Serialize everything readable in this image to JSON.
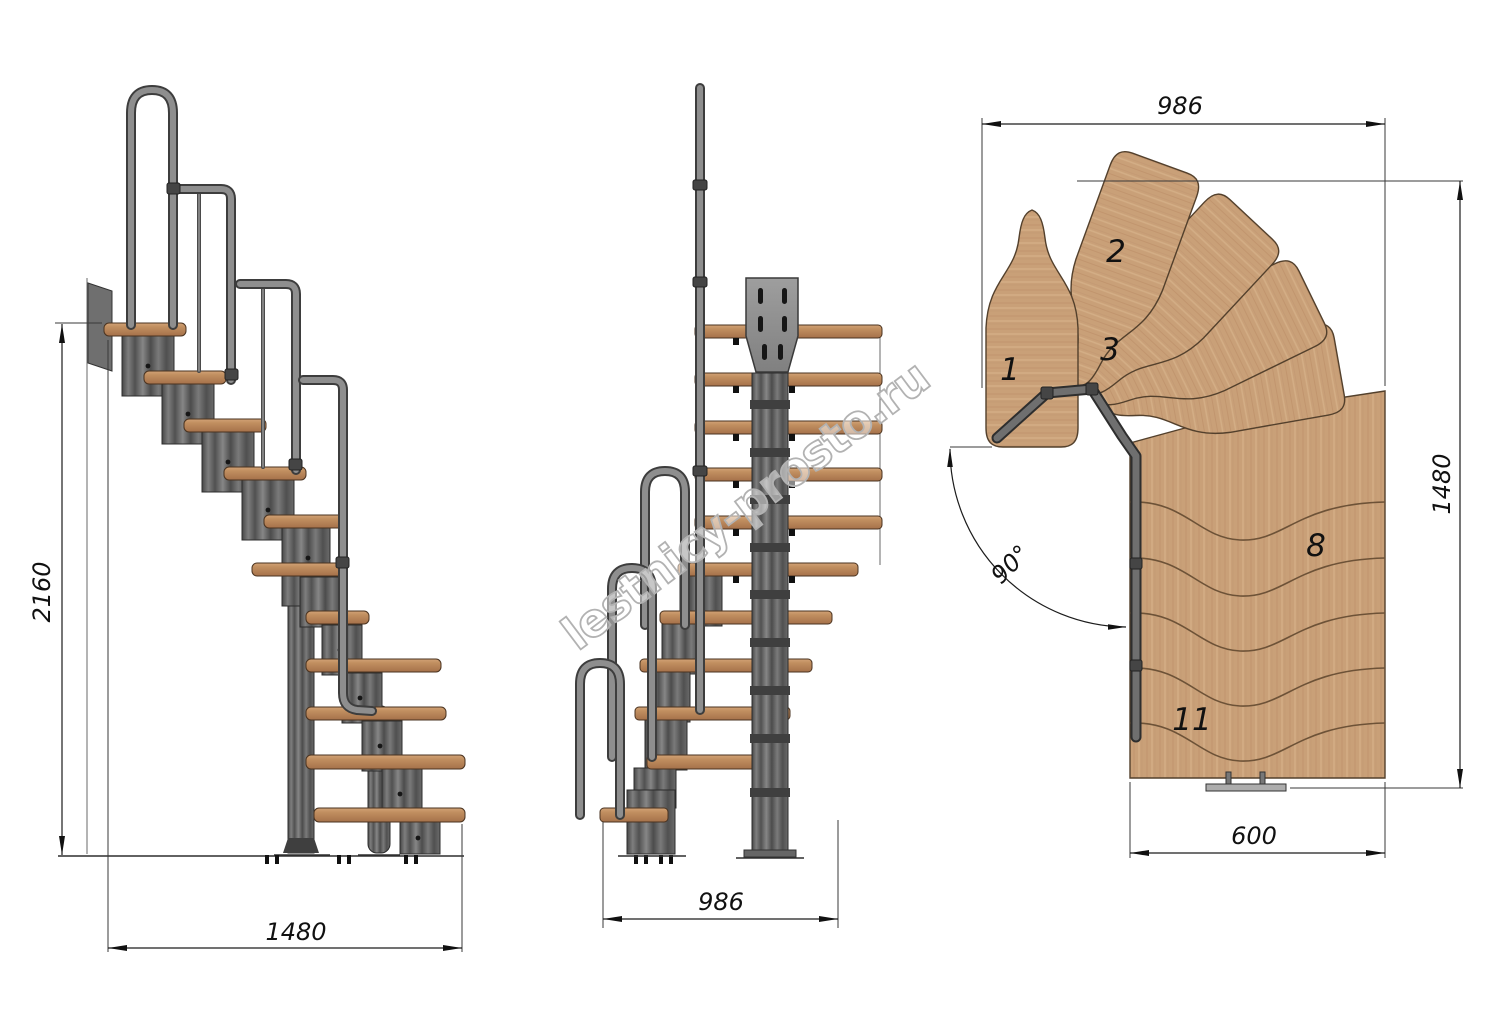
{
  "watermark": "lestnicy-prosto.ru",
  "side_view": {
    "height": "2160",
    "length": "1480"
  },
  "front_view": {
    "width": "986"
  },
  "plan_view": {
    "width": "986",
    "depth": "1480",
    "flight_width": "600",
    "turn_angle": "90°",
    "step_numbers": {
      "first": "1",
      "second": "2",
      "third": "3",
      "eighth": "8",
      "eleventh": "11"
    }
  },
  "colors": {
    "wood_plan": "#c9a078",
    "wood_front": "#b5825a",
    "metal": "#787878",
    "dimension_line": "#1c1c1c"
  }
}
